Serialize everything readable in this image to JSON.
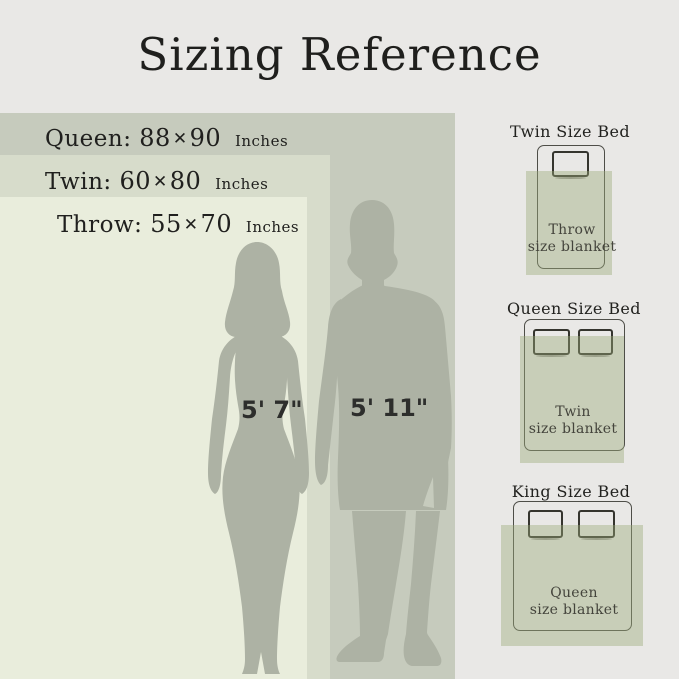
{
  "title": "Sizing Reference",
  "legend": {
    "items": [
      {
        "name": "Queen:",
        "width": "88",
        "times": "✕",
        "height": "90",
        "unit": "Inches"
      },
      {
        "name": "Twin:",
        "width": "60",
        "times": "✕",
        "height": "80",
        "unit": "Inches"
      },
      {
        "name": "Throw:",
        "width": "55",
        "times": "✕",
        "height": "70",
        "unit": "Inches"
      }
    ]
  },
  "figures": {
    "woman_height": "5' 7\"",
    "man_height": "5' 11\""
  },
  "beds": {
    "twin": {
      "title": "Twin Size Bed",
      "blanket_line1": "Throw",
      "blanket_line2": "size blanket"
    },
    "queen": {
      "title": "Queen Size Bed",
      "blanket_line1": "Twin",
      "blanket_line2": "size blanket"
    },
    "king": {
      "title": "King Size Bed",
      "blanket_line1": "Queen",
      "blanket_line2": "size blanket"
    }
  },
  "colors": {
    "bg": "#e9e8e6",
    "queen": "#c6cbbd",
    "twin": "#d7dccb",
    "throw": "#e9eddc",
    "fig": "#adb2a4",
    "blanket": "rgba(154,170,122,0.42)",
    "ink": "#1f1f1d",
    "bed_line": "#4e4e48",
    "pillow_line": "#35352e",
    "label_ink": "#44443c"
  }
}
